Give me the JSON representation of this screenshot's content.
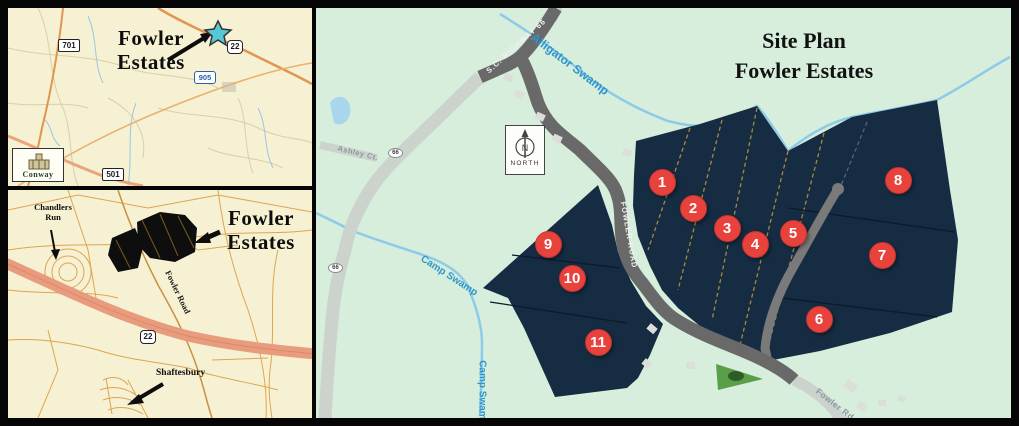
{
  "regional_map": {
    "callout_line1": "Fowler",
    "callout_line2": "Estates",
    "route_701": "701",
    "route_22": "22",
    "route_905": "905",
    "route_501": "501",
    "city_logo": "Conway"
  },
  "local_map": {
    "chandlers_line1": "Chandlers",
    "chandlers_line2": "Run",
    "callout_line1": "Fowler",
    "callout_line2": "Estates",
    "fowler_road": "Fowler Road",
    "route_22": "22",
    "shaftesbury": "Shaftesbury"
  },
  "site_plan": {
    "title_line1": "Site Plan",
    "title_line2": "Fowler Estates",
    "north_label": "NORTH",
    "north_letter": "N",
    "roads": {
      "sc_highway_66": "S.C. HIGHWAY 66",
      "fowler_road": "FOWLER ROAD",
      "fowler_rd": "Fowler Rd",
      "ashley_ct": "Ashley Ct.",
      "route_66": "66"
    },
    "streams": {
      "alligator_swamp": "Alligator Swamp",
      "camp_swamp": "Camp Swamp"
    },
    "marker_color": "#e8423d",
    "lots": [
      {
        "number": "1",
        "x": 346,
        "y": 174
      },
      {
        "number": "2",
        "x": 377,
        "y": 200
      },
      {
        "number": "3",
        "x": 411,
        "y": 220
      },
      {
        "number": "4",
        "x": 439,
        "y": 236
      },
      {
        "number": "5",
        "x": 477,
        "y": 225
      },
      {
        "number": "6",
        "x": 503,
        "y": 311
      },
      {
        "number": "7",
        "x": 566,
        "y": 247
      },
      {
        "number": "8",
        "x": 582,
        "y": 172
      },
      {
        "number": "9",
        "x": 232,
        "y": 236
      },
      {
        "number": "10",
        "x": 256,
        "y": 270
      },
      {
        "number": "11",
        "x": 282,
        "y": 334
      }
    ],
    "colors": {
      "map_cream": "#f6f1d3",
      "site_background": "#d6eedb",
      "parcel_navy": "#152c43",
      "marker_red": "#e8423d",
      "stream_blue": "#8ecbe8",
      "stream_label_blue": "#2f96cc",
      "road_dark": "#696969",
      "road_light": "#ccd3cd",
      "highway_salmon": "#e89b7d",
      "estate_black": "#0e0e0e",
      "lot_line_gold": "#a8893a"
    }
  }
}
